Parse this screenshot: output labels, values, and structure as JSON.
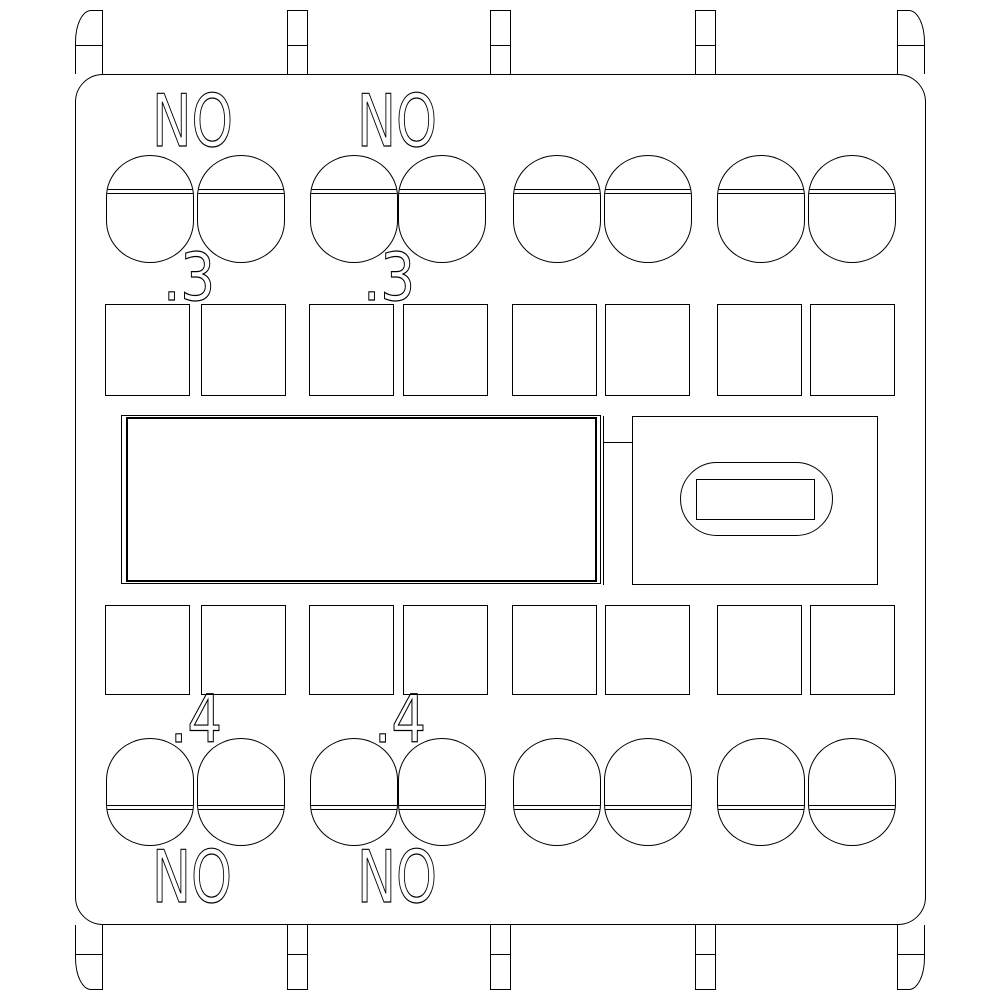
{
  "drawing": {
    "background": "#ffffff",
    "line_color": "#000000",
    "labels": {
      "no_top_left": "NO",
      "no_top_mid": "NO",
      "contact_3_left": ".3",
      "contact_3_right": ".3",
      "contact_4_left": ".4",
      "contact_4_right": ".4",
      "no_bottom_left": "NO",
      "no_bottom_mid": "NO"
    }
  }
}
